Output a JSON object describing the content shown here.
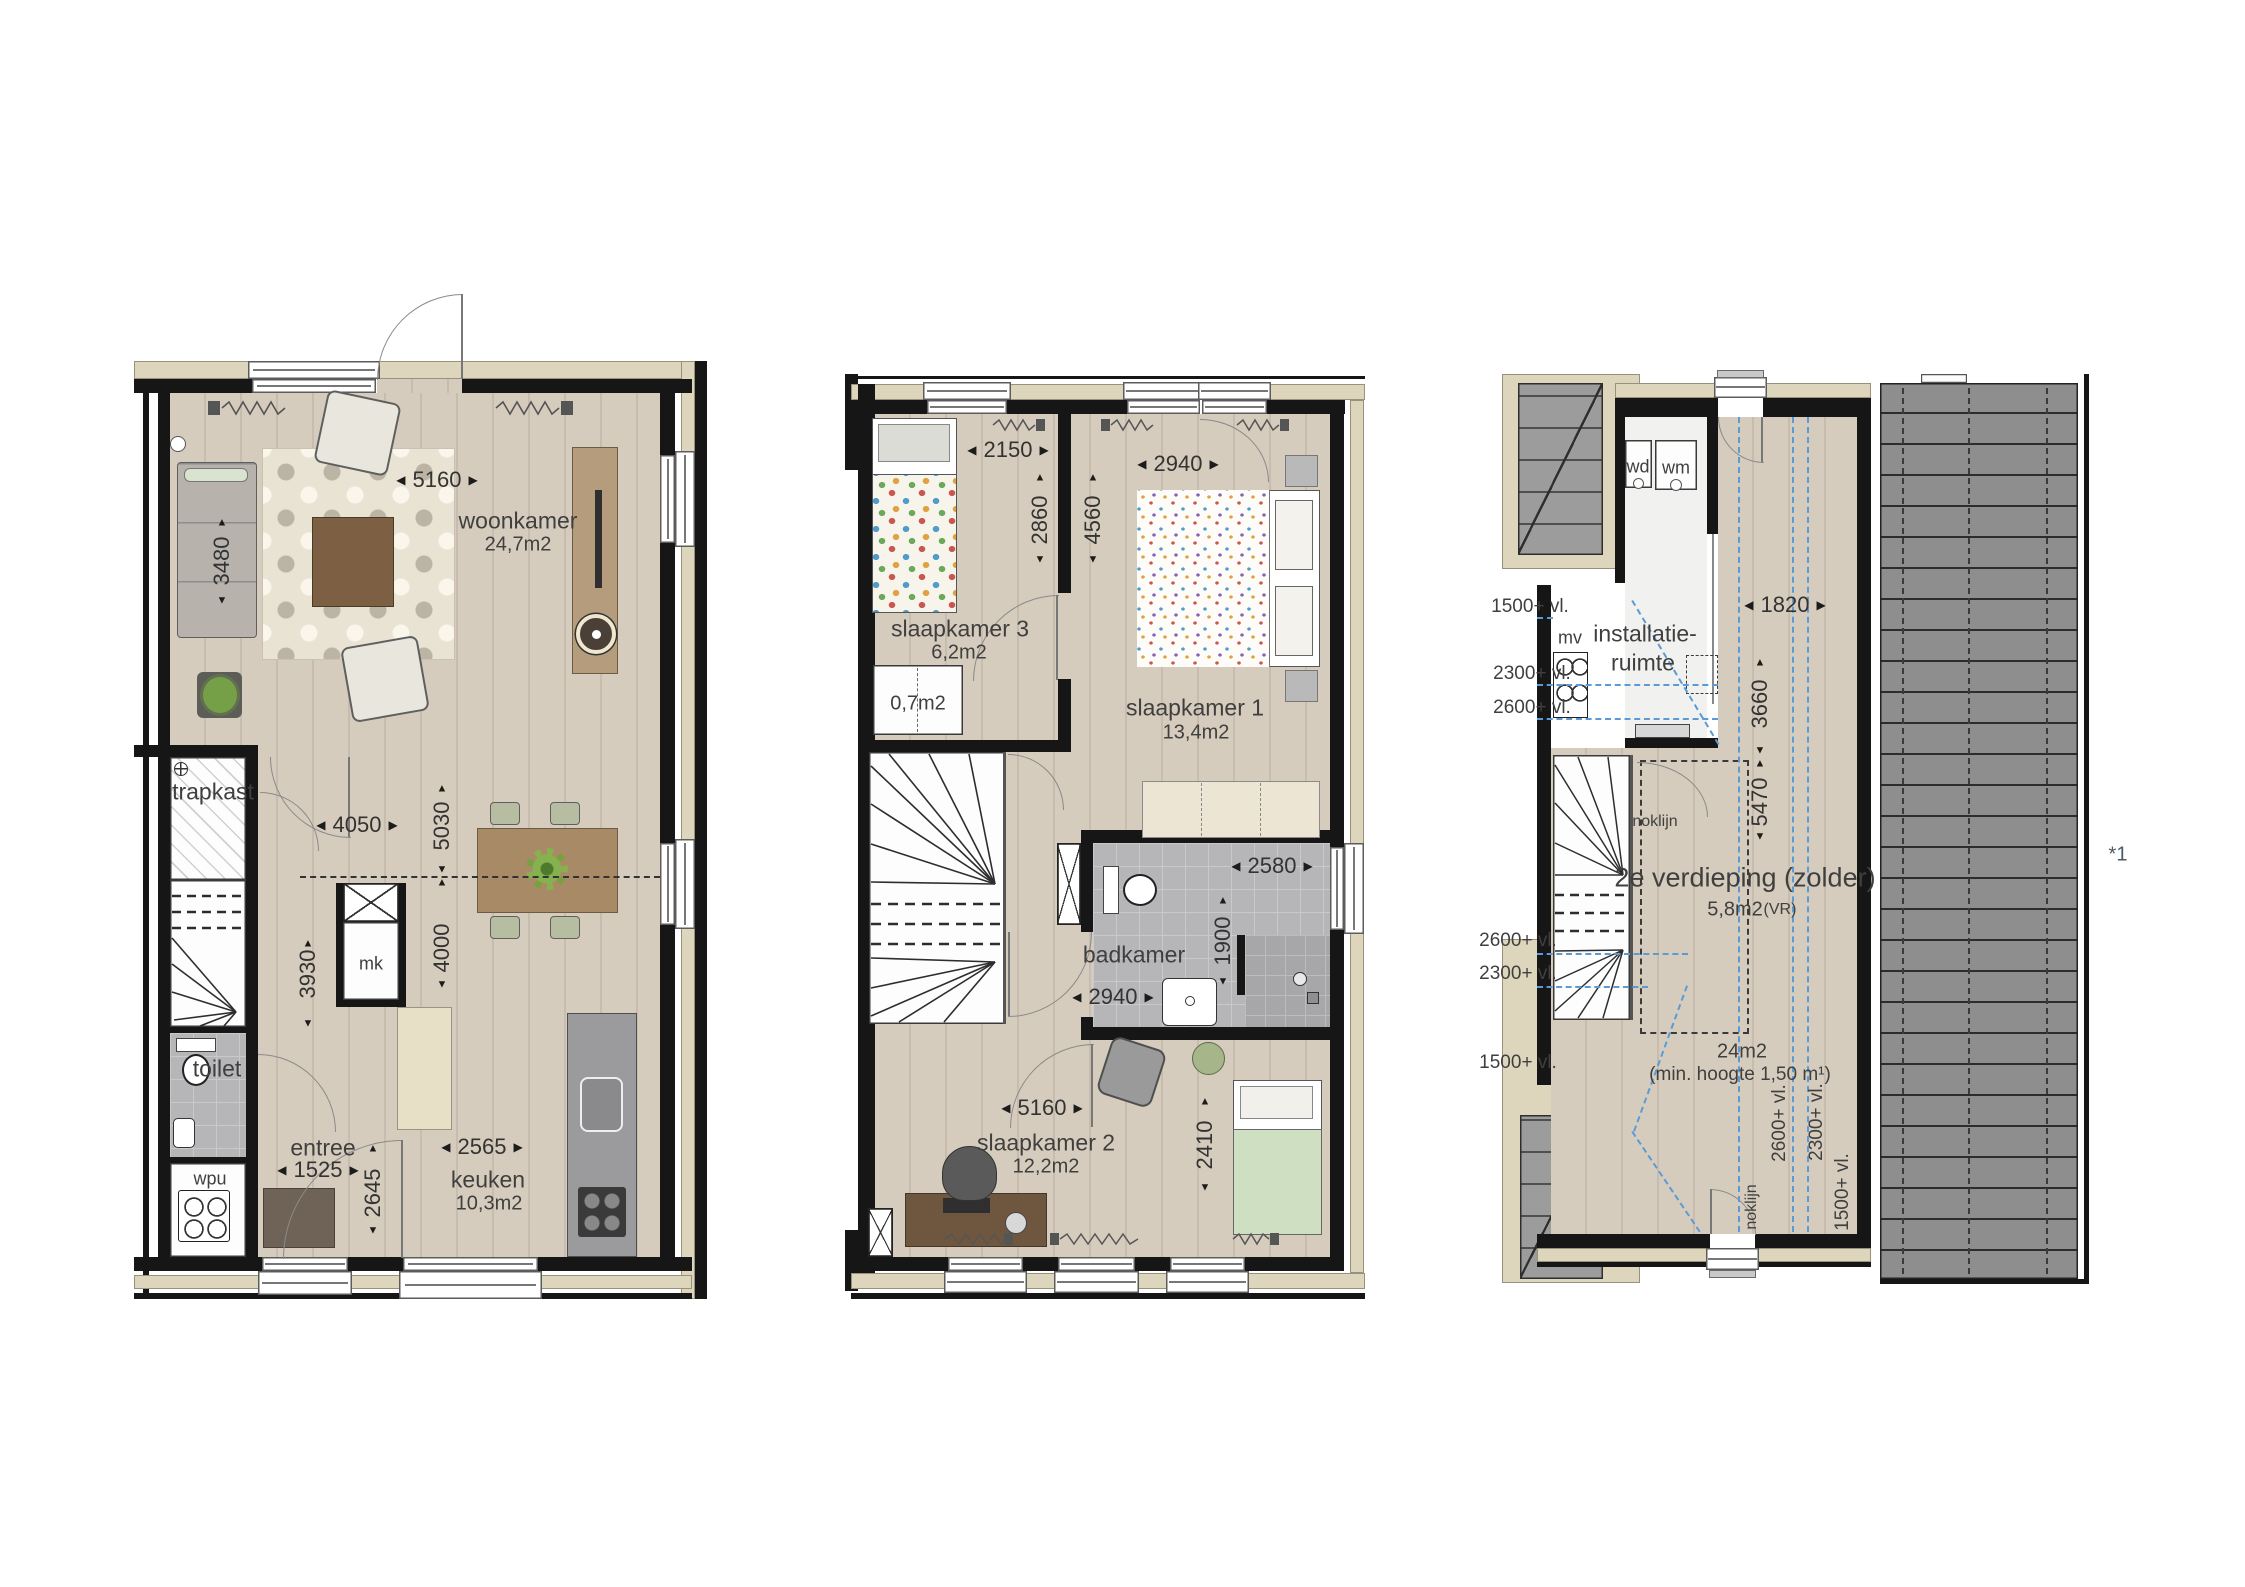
{
  "icons": {
    "arrow_left": "◀",
    "arrow_right": "▶",
    "arrow_up": "▲",
    "arrow_down": "▼",
    "sofa": "sofa",
    "armchair": "armchair",
    "rug": "rug",
    "coffee-table": "coffee-table",
    "plant": "plant",
    "tv-cabinet": "tv-cabinet",
    "dining-table": "dining-table",
    "spiral-stairs": "spiral-stairs",
    "bed": "bed",
    "desk": "desk",
    "shower": "shower",
    "toilet-fixture": "toilet",
    "washbasin": "washbasin",
    "radiator": "radiator"
  },
  "colors": {
    "wall": "#161616",
    "cream_band": "#ddd6bc",
    "wood_floor": "#d3c8b9",
    "tile": "#b6b6b8",
    "roof": "#8e8e8e",
    "level_line_blue": "#5b9bd5"
  },
  "plan1": {
    "rooms": {
      "woonkamer": {
        "name": "woonkamer",
        "area": "24,7m2"
      },
      "trapkast": {
        "name": "trapkast"
      },
      "toilet": {
        "name": "toilet"
      },
      "wpu": {
        "name": "wpu"
      },
      "entree": {
        "name": "entree"
      },
      "keuken": {
        "name": "keuken",
        "area": "10,3m2"
      },
      "mk": {
        "name": "mk"
      }
    },
    "dims": {
      "living_width": "5160",
      "sofa_wall": "3480",
      "hall_width": "4050",
      "dining_upper": "5030",
      "dining_lower": "4000",
      "hall_height": "3930",
      "entree_width": "1525",
      "entree_height": "2645",
      "kitchen_width": "2565"
    }
  },
  "plan2": {
    "rooms": {
      "slaapkamer3": {
        "name": "slaapkamer 3",
        "area": "6,2m2"
      },
      "kast": {
        "area": "0,7m2"
      },
      "slaapkamer1": {
        "name": "slaapkamer 1",
        "area": "13,4m2"
      },
      "badkamer": {
        "name": "badkamer"
      },
      "slaapkamer2": {
        "name": "slaapkamer 2",
        "area": "12,2m2"
      }
    },
    "dims": {
      "sk3_width": "2150",
      "sk3_height": "2860",
      "sk1_width": "2940",
      "sk1_height": "4560",
      "bad_width": "2580",
      "bad_height": "1900",
      "bad_width2": "2940",
      "sk2_width": "5160",
      "sk2_height": "2410"
    }
  },
  "plan3": {
    "rooms": {
      "wd": "wd",
      "wm": "wm",
      "mv": "mv",
      "install_line1": "installatie-",
      "install_line2": "ruimte",
      "zolder_name": "2e verdieping (zolder)",
      "zolder_area": "5,8m2",
      "zolder_suffix": "(VR)",
      "floor_area": "24m2",
      "floor_note": "(min. hoogte 1,50 m¹)"
    },
    "dims": {
      "attic_width": "1820",
      "attic_upper": "3660",
      "attic_lower": "5470"
    },
    "levels": {
      "top": [
        "1500+ vl.",
        "2300+ vl.",
        "2600+ vl."
      ],
      "mid": [
        "2600+ vl.",
        "2300+ vl.",
        "1500+ vl."
      ],
      "rotated": [
        "2600+ vl.",
        "2300+ vl.",
        "1500+ vl."
      ]
    },
    "noklijn": "noklijn",
    "footnote": "*1"
  }
}
